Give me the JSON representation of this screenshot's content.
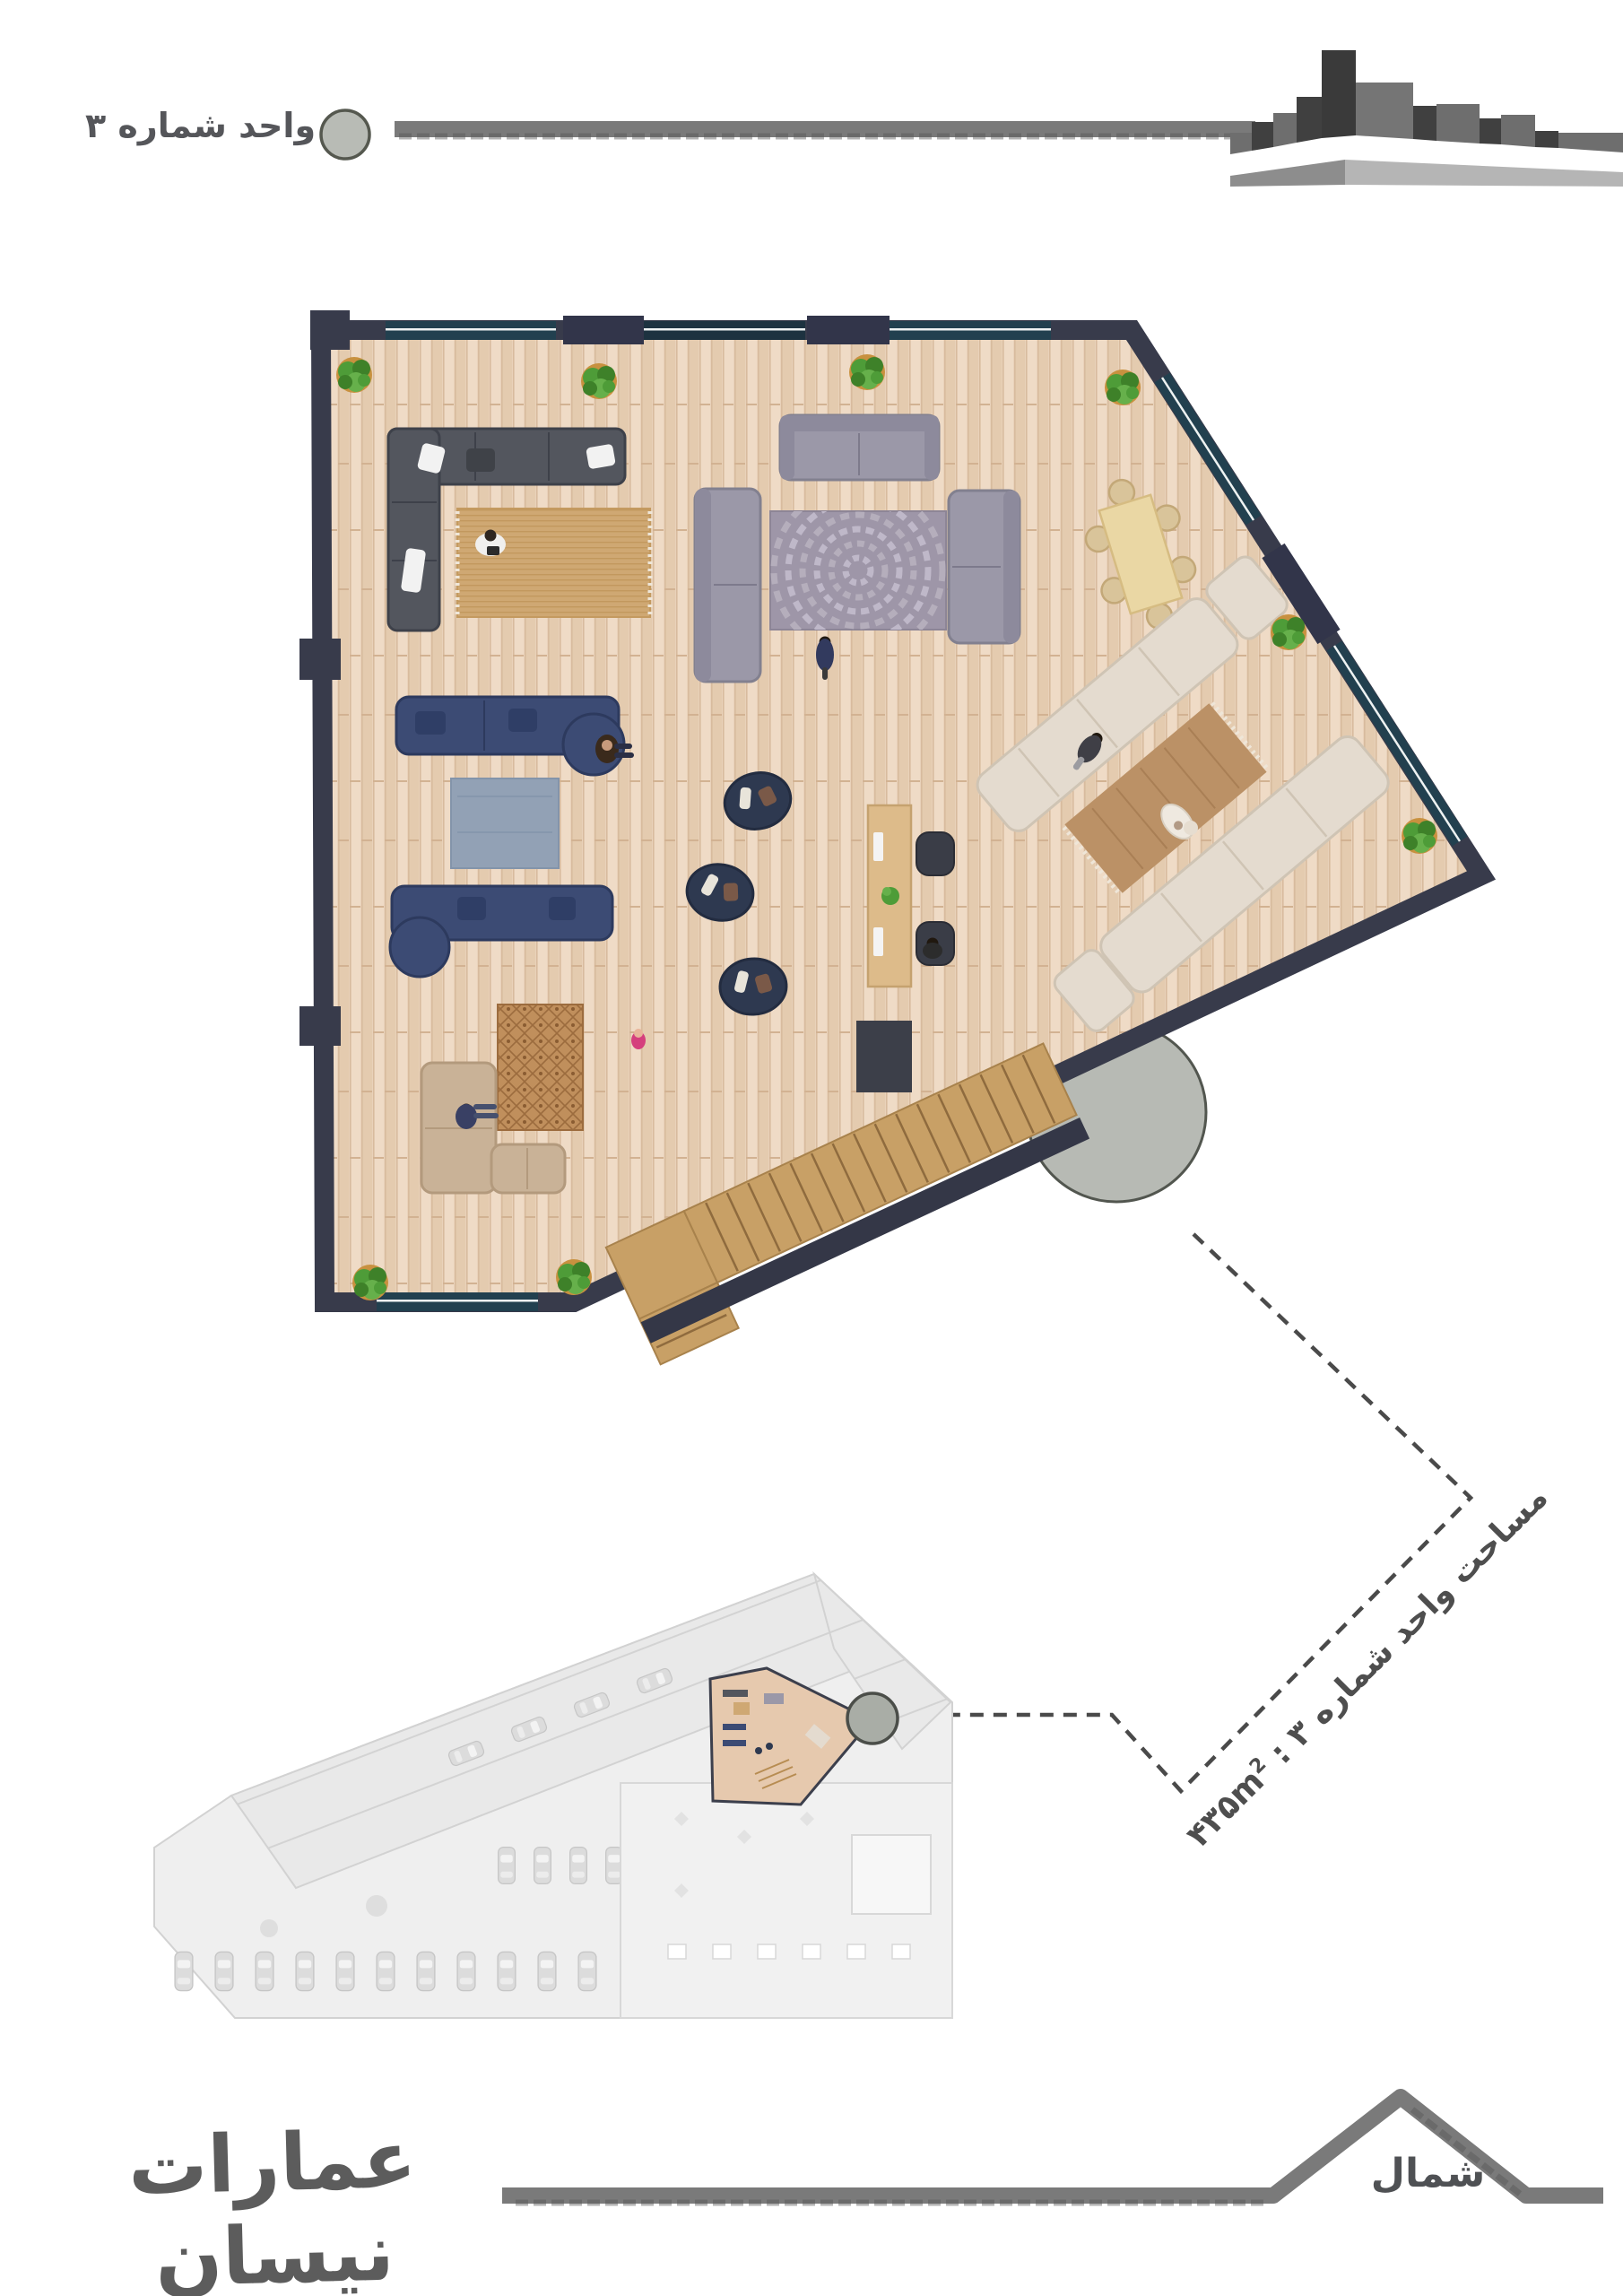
{
  "header": {
    "unit_label": "واحد شماره ۳",
    "marker_icon": "circle-marker-icon",
    "skyline_icon": "building-massing-sketch"
  },
  "callout": {
    "area_label": "مساحت واحد شماره ۳ : ",
    "area_value": "۴۳۵m",
    "area_sup": "2",
    "area_full_text": "مساحت واحد شماره ۳ : ۴۳۵m²"
  },
  "footer": {
    "brand": "عمارات نیسان",
    "north_label": "شمال",
    "north_icon": "mountain-peak-sketch"
  },
  "plan": {
    "unit_number": "۳",
    "area_m2": 435,
    "elements": [
      "charcoal-l-sofa",
      "tan-rug",
      "gray-sofa-top",
      "gray-sofa-left",
      "gray-sofa-right",
      "mosaic-circle-rug",
      "dining-table-6-chairs",
      "navy-sofa-upper",
      "navy-sofa-lower",
      "slate-rug",
      "patterned-rug",
      "beige-l-sofa",
      "pouf-chair-1",
      "pouf-chair-2",
      "pouf-chair-3",
      "work-desk-2-monitors",
      "office-chairs",
      "elevator-landing",
      "l-shaped-stairs",
      "semicircle-balcony",
      "cream-sofa-left",
      "cream-sofa-right",
      "brown-fringe-rug",
      "corner-plants-8",
      "people-figures"
    ]
  },
  "mini_plan": {
    "description": "overall-site-plan-grayed",
    "highlight": "unit-3-colored",
    "marker_icon": "circle-marker-icon",
    "features": [
      "angled-unit-band",
      "parking-cars",
      "courtyard",
      "table-row"
    ]
  },
  "colors": {
    "wall": "#383b4b",
    "floor": "#e9d2ba",
    "glass": "#22404f",
    "navy_sofa": "#3c4b74",
    "gray_sofa": "#9b98a8",
    "cream_sofa": "#e4dbcf",
    "charcoal_sofa": "#53565e",
    "tan_rug": "#cfa873",
    "stairs_wood": "#c8a066",
    "balcony_gray": "#b7bab4",
    "sketch_gray": "#6f6f6f",
    "text_gray": "#55565a",
    "mini_gray": "#efefef",
    "plant_green": "#4e9c38"
  }
}
